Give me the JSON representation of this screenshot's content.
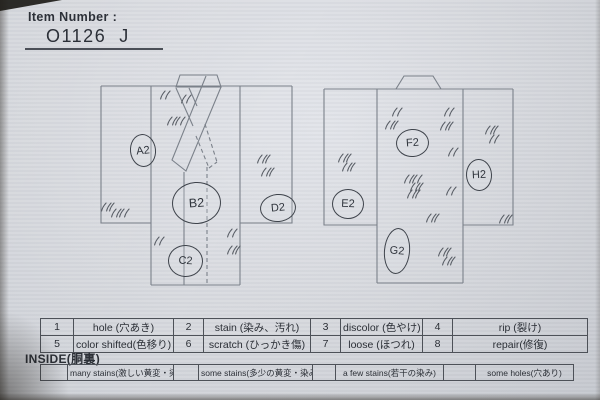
{
  "header": {
    "item_number_label": "Item Number :",
    "item_number_value": "O1126  J"
  },
  "diagram": {
    "markers": [
      {
        "label": "A2"
      },
      {
        "label": "B2"
      },
      {
        "label": "C2"
      },
      {
        "label": "D2"
      },
      {
        "label": "E2"
      },
      {
        "label": "F2"
      },
      {
        "label": "G2"
      },
      {
        "label": "H2"
      }
    ],
    "marks": [
      [
        165,
        95,
        2
      ],
      [
        186,
        99,
        2
      ],
      [
        176,
        121,
        4
      ],
      [
        264,
        159,
        3
      ],
      [
        268,
        172,
        3
      ],
      [
        108,
        207,
        3
      ],
      [
        120,
        213,
        4
      ],
      [
        159,
        241,
        2
      ],
      [
        232,
        233,
        2
      ],
      [
        234,
        250,
        3
      ],
      [
        397,
        112,
        2
      ],
      [
        392,
        125,
        3
      ],
      [
        449,
        112,
        2
      ],
      [
        447,
        126,
        3
      ],
      [
        492,
        130,
        3
      ],
      [
        494,
        139,
        2
      ],
      [
        453,
        152,
        2
      ],
      [
        345,
        158,
        3
      ],
      [
        349,
        167,
        3
      ],
      [
        413,
        179,
        4
      ],
      [
        417,
        187,
        3
      ],
      [
        414,
        194,
        3
      ],
      [
        451,
        191,
        2
      ],
      [
        433,
        218,
        3
      ],
      [
        445,
        252,
        3
      ],
      [
        449,
        261,
        3
      ],
      [
        506,
        219,
        3
      ]
    ]
  },
  "defect_table": {
    "rows": [
      [
        {
          "num": "1",
          "desc": "hole (穴あき)"
        },
        {
          "num": "2",
          "desc": "stain (染み、汚れ)"
        },
        {
          "num": "3",
          "desc": "discolor (色やけ)"
        },
        {
          "num": "4",
          "desc": "rip (裂け)"
        }
      ],
      [
        {
          "num": "5",
          "desc": "color shifted(色移り)"
        },
        {
          "num": "6",
          "desc": "scratch (ひっかき傷)"
        },
        {
          "num": "7",
          "desc": "loose (ほつれ)"
        },
        {
          "num": "8",
          "desc": "repair(修復)"
        }
      ]
    ]
  },
  "inside_section": {
    "label": "INSIDE(胴裏)",
    "options": [
      {
        "label": "many stains(激しい黄変・染み)"
      },
      {
        "label": "some stains(多少の黄変・染み)"
      },
      {
        "label": "a few stains(若干の染み)"
      },
      {
        "label": "some holes(穴あり)"
      }
    ]
  }
}
